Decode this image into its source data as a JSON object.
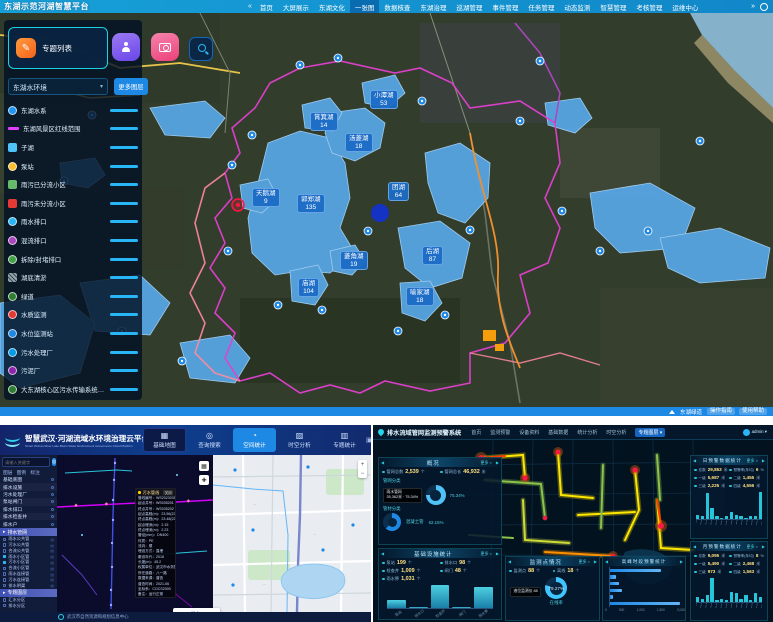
{
  "top": {
    "title": "东湖示范河湖智慧平台",
    "nav": [
      {
        "label": "首页"
      },
      {
        "label": "大屏展示"
      },
      {
        "label": "东湖文化"
      },
      {
        "label": "一张图",
        "active": true
      },
      {
        "label": "数据核查"
      },
      {
        "label": "东湖治理"
      },
      {
        "label": "巡湖管理"
      },
      {
        "label": "事件管理"
      },
      {
        "label": "任务管理"
      },
      {
        "label": "动态监测"
      },
      {
        "label": "智慧管理"
      },
      {
        "label": "考核管理"
      },
      {
        "label": "运维中心"
      }
    ],
    "panel": {
      "topic_list": "专题列表",
      "dropdown_value": "东湖水环境",
      "more_layers": "更多图层"
    },
    "layers": [
      {
        "label": "东湖水系",
        "icon_color": "#2196f3",
        "type": "circle"
      },
      {
        "label": "东湖风景区红线范围",
        "icon_color": "#e040fb",
        "type": "line"
      },
      {
        "label": "子湖",
        "icon_color": "#4fc3f7",
        "type": "square"
      },
      {
        "label": "泵站",
        "icon_color": "#fbc02d",
        "type": "circle"
      },
      {
        "label": "雨污已分流小区",
        "icon_color": "#66bb6a",
        "type": "square"
      },
      {
        "label": "雨污未分流小区",
        "icon_color": "#e53935",
        "type": "square"
      },
      {
        "label": "雨水排口",
        "icon_color": "#29b6f6",
        "type": "circle"
      },
      {
        "label": "混流排口",
        "icon_color": "#ab47bc",
        "type": "circle"
      },
      {
        "label": "拆除/封堵排口",
        "icon_color": "#43a047",
        "type": "circle"
      },
      {
        "label": "湖底清淤",
        "icon_color": "#90a4ae",
        "type": "hatch"
      },
      {
        "label": "绿道",
        "icon_color": "#2e7d32",
        "type": "circle"
      },
      {
        "label": "水质监测",
        "icon_color": "#e53935",
        "type": "circle"
      },
      {
        "label": "水位监测站",
        "icon_color": "#1e88e5",
        "type": "circle"
      },
      {
        "label": "污水处理厂",
        "icon_color": "#039be5",
        "type": "circle"
      },
      {
        "label": "污泥厂",
        "icon_color": "#8e24aa",
        "type": "circle"
      },
      {
        "label": "大东湖核心区污水传输系统工程",
        "icon_color": "#2e7d32",
        "type": "circle"
      }
    ],
    "lake_labels": [
      {
        "name": "小潭湖",
        "count": "53",
        "x": 370,
        "y": 90
      },
      {
        "name": "筲箕湖",
        "count": "14",
        "x": 310,
        "y": 112
      },
      {
        "name": "汤菱湖",
        "count": "18",
        "x": 345,
        "y": 133
      },
      {
        "name": "团湖",
        "count": "64",
        "x": 388,
        "y": 182
      },
      {
        "name": "天鹅湖",
        "count": "9",
        "x": 252,
        "y": 188
      },
      {
        "name": "郭郑湖",
        "count": "135",
        "x": 297,
        "y": 194
      },
      {
        "name": "后湖",
        "count": "87",
        "x": 422,
        "y": 246
      },
      {
        "name": "菱角湖",
        "count": "19",
        "x": 340,
        "y": 251
      },
      {
        "name": "庙湖",
        "count": "104",
        "x": 298,
        "y": 278
      },
      {
        "name": "喻家湖",
        "count": "18",
        "x": 406,
        "y": 287
      }
    ],
    "bottom_bar": {
      "status": "东湖绿道",
      "buttons": [
        {
          "label": "操作指南"
        },
        {
          "label": "使用帮助"
        }
      ]
    }
  },
  "bottom_left": {
    "header": {
      "title": "智慧武汉·河湖流域水环境治理云平台",
      "subtitle": "Smart Wuhan River Lake Basin Water Environment Governance Cloud Platform",
      "tabs": [
        {
          "label": "基础地图",
          "icon": "▦",
          "dark": true
        },
        {
          "label": "查询搜索",
          "icon": "◎"
        },
        {
          "label": "空间统计",
          "icon": "◔",
          "active": true
        },
        {
          "label": "时空分析",
          "icon": "▨"
        },
        {
          "label": "专题统计",
          "icon": "▥"
        }
      ]
    },
    "sidebar": {
      "search_placeholder": "请输入关键字",
      "tabs": [
        {
          "label": "图层"
        },
        {
          "label": "图例"
        },
        {
          "label": "标注"
        }
      ],
      "groups": [
        {
          "label": "基础底图"
        },
        {
          "label": "排水设施"
        },
        {
          "label": "污水处理厂"
        },
        {
          "label": "泵站闸门"
        },
        {
          "label": "排水排口"
        },
        {
          "label": "排水检查井"
        },
        {
          "label": "排水户"
        }
      ],
      "active_group": "排水管网",
      "layers": [
        {
          "label": "雨水公共管"
        },
        {
          "label": "污水公共管"
        },
        {
          "label": "合流公共管"
        },
        {
          "label": "雨水小区管",
          "checked": true
        },
        {
          "label": "污水小区管",
          "checked": true
        },
        {
          "label": "合流小区管"
        },
        {
          "label": "雨水连接管"
        },
        {
          "label": "污水连接管"
        },
        {
          "label": "排水明渠"
        }
      ],
      "group2": "专题图层",
      "sub2": [
        {
          "label": "汇水分区"
        },
        {
          "label": "排水分区"
        }
      ]
    },
    "popup": {
      "title": "污水管线",
      "close_label": "关闭",
      "rows": [
        "管线编号：WS20230355662",
        "起点井号：WS035201",
        "终点井号：WS035202",
        "起点高程(m)：23.56(22.41)",
        "终点高程(m)：23.48(22.35)",
        "起点埋深(m)：2.15",
        "终点埋深(m)：2.23",
        "管径(mm)：DN400",
        "材质：PE",
        "流向：顺",
        "埋设方式：直埋",
        "敷设年代：2016",
        "长度(m)：45.2",
        "权属单位：武汉市水务集团",
        "所在道路：八一路",
        "数据来源：普查",
        "普查时间：2021-06",
        "坐标系：CGCS2000",
        "备注：运行正常"
      ]
    },
    "legend": [
      {
        "label": "污水",
        "color": "#d500f9"
      },
      {
        "label": "雨水",
        "color": "#00b0ff"
      }
    ],
    "footer": "武汉市自然资源和规划信息中心"
  },
  "bottom_right": {
    "header": {
      "title": "排水流域管网监测预警系统",
      "nav": [
        {
          "label": "首页"
        },
        {
          "label": "监测预警"
        },
        {
          "label": "设备资料"
        },
        {
          "label": "基础数据"
        },
        {
          "label": "统计分析"
        },
        {
          "label": "时空分析"
        },
        {
          "label": "专题图层 ▾",
          "active": true
        }
      ],
      "user": "admin ▾"
    },
    "overview": {
      "title": "概况",
      "more": "更多 >",
      "stats": [
        {
          "label": "管网总数",
          "value": "2,539",
          "unit": "个"
        },
        {
          "label": "管网总长",
          "value": "46,932",
          "unit": "米"
        }
      ],
      "sec1": "管网分类",
      "donut1": {
        "pct": 75.34,
        "color": "#4fc3f7"
      },
      "tooltip1a": "雨水管网",
      "tooltip1b": "35,362米 · 75.34%",
      "pct1": "75.34%",
      "sec2": "管材分类",
      "donut2": {
        "pct": 62.15,
        "color": "#1e88e5"
      },
      "mat_name": "混凝土管",
      "pct2": "62.15%"
    },
    "facilities": {
      "title": "基础设施统计",
      "more": "更多 >",
      "stats": [
        {
          "label": "泵站",
          "value": "199",
          "unit": "个"
        },
        {
          "label": "排水口",
          "value": "98",
          "unit": "个"
        },
        {
          "label": "检查井",
          "value": "1,009",
          "unit": "个"
        },
        {
          "label": "闸门",
          "value": "48",
          "unit": "个"
        },
        {
          "label": "雨水箅",
          "value": "1,031",
          "unit": "个"
        }
      ],
      "chart": {
        "type": "bar",
        "categories": [
          "泵站",
          "排水口",
          "检查井",
          "闸门",
          "雨水箅"
        ],
        "values": [
          62,
          6,
          175,
          8,
          158
        ]
      }
    },
    "monitor": {
      "title": "监测点情况",
      "more": "更多 >",
      "stats": [
        {
          "label": "监测点",
          "value": "88",
          "unit": "个"
        },
        {
          "label": "离线",
          "value": "18",
          "unit": "个"
        }
      ],
      "tooltip": "液位监测仪 88",
      "donut": {
        "pct": 79.27,
        "color": "#40c4ff"
      },
      "pct_text": "79.27%",
      "caption": "在线率"
    },
    "peak": {
      "title": "高峰时段预警统计",
      "chart": {
        "type": "bar-horizontal",
        "values": [
          1450,
          160,
          240,
          330,
          90,
          1980
        ],
        "max": 2000,
        "ticks": [
          "0",
          "500",
          "1,000",
          "1,500",
          "2,000"
        ]
      }
    },
    "warn_day": {
      "title": "日预警数据统计",
      "more": "更多 >",
      "stats": [
        {
          "label": "总数",
          "value": "29,853",
          "unit": "米"
        },
        {
          "label": "预警率(年均)",
          "value": "6",
          "unit": "%"
        },
        {
          "label": "一级",
          "value": "5,687",
          "unit": "米"
        },
        {
          "label": "二级",
          "value": "1,455",
          "unit": "米"
        },
        {
          "label": "三级",
          "value": "2,225",
          "unit": "米"
        },
        {
          "label": "四级",
          "value": "4,556",
          "unit": "米"
        }
      ],
      "chart": {
        "type": "bar",
        "values": [
          3,
          2,
          18,
          8,
          2,
          1,
          2,
          5,
          3,
          2,
          1,
          2,
          2,
          19
        ]
      }
    },
    "warn_month": {
      "title": "月预警数据统计",
      "more": "更多 >",
      "stats": [
        {
          "label": "总数",
          "value": "9,095",
          "unit": "米"
        },
        {
          "label": "预警率(年均)",
          "value": "8",
          "unit": "%"
        },
        {
          "label": "一级",
          "value": "5,490",
          "unit": "米"
        },
        {
          "label": "二级",
          "value": "2,468",
          "unit": "米"
        },
        {
          "label": "三级",
          "value": "973",
          "unit": "米"
        },
        {
          "label": "四级",
          "value": "1,563",
          "unit": "米"
        }
      ],
      "chart": {
        "type": "bar",
        "values": [
          4,
          3,
          6,
          21,
          2,
          3,
          2,
          9,
          8,
          3,
          6,
          2,
          8,
          4
        ]
      }
    }
  }
}
